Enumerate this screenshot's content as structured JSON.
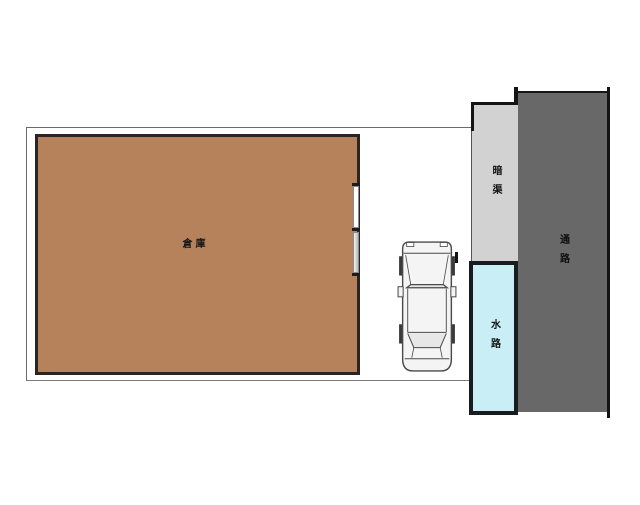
{
  "plan": {
    "areas": {
      "warehouse": {
        "label": "倉庫",
        "fill": "#b5825c",
        "border": "#2b2423"
      },
      "culvert": {
        "label": "暗渠",
        "fill": "#d2d2d2"
      },
      "waterway": {
        "label": "水路",
        "fill": "#c9eef6",
        "border": "#181c1e"
      },
      "passage": {
        "label": "通路",
        "fill": "#686868"
      }
    },
    "colors": {
      "background": "#ffffff",
      "boundary_line": "#6a6a6a",
      "outline_black": "#141414",
      "car_fill": "#f4f4f4",
      "car_outline": "#4a4a4a"
    }
  }
}
